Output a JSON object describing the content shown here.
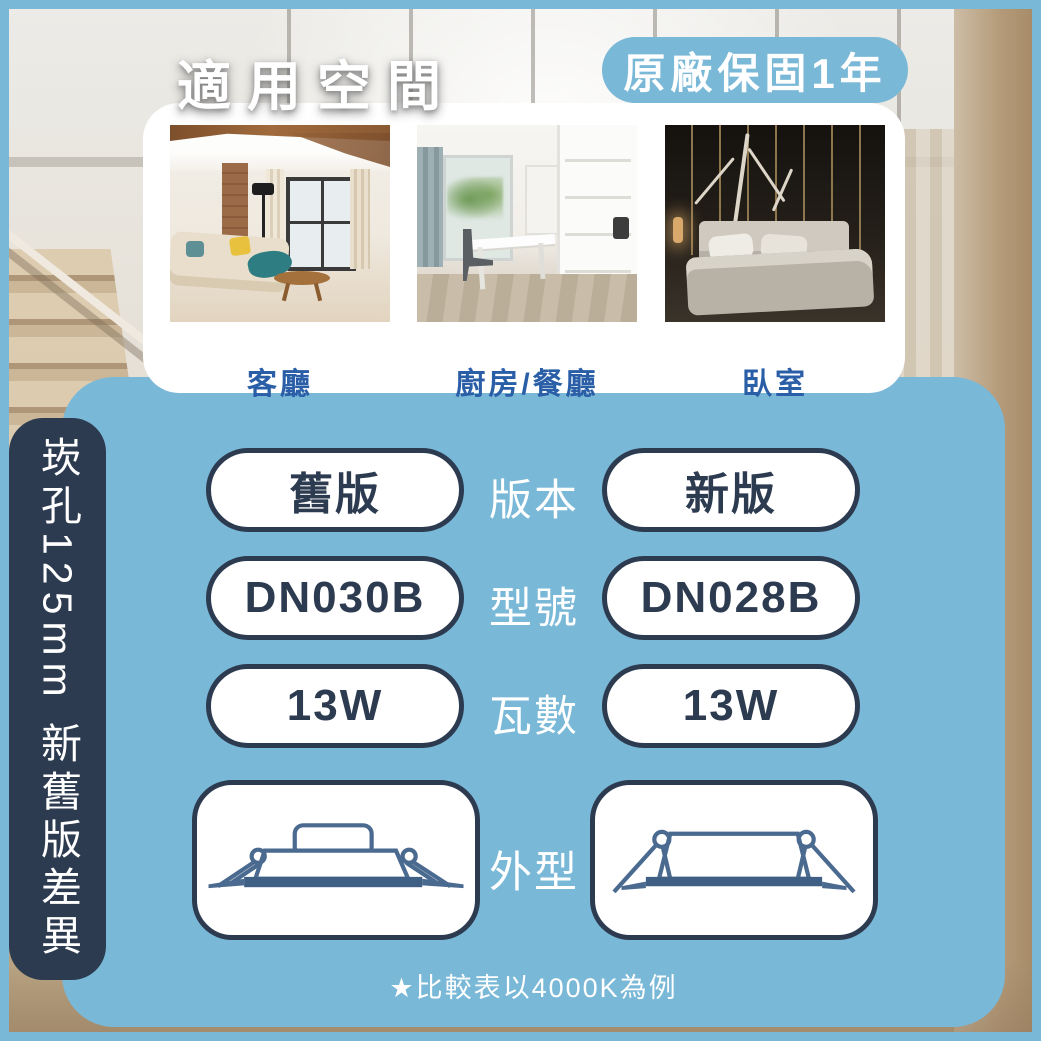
{
  "header": {
    "title": "適用空間",
    "warranty_badge": "原廠保固1年"
  },
  "spaces": [
    {
      "label": "客廳"
    },
    {
      "label": "廚房/餐廳"
    },
    {
      "label": "臥室"
    }
  ],
  "sidebar": {
    "text": "崁孔125mm 新舊版差異"
  },
  "comparison": {
    "old_column": "舊版",
    "new_column": "新版",
    "rows": [
      {
        "label": "版本",
        "old": "舊版",
        "new": "新版"
      },
      {
        "label": "型號",
        "old": "DN030B",
        "new": "DN028B"
      },
      {
        "label": "瓦數",
        "old": "13W",
        "new": "13W"
      }
    ],
    "shape_label": "外型",
    "footnote": "★比較表以4000K為例"
  },
  "colors": {
    "panel_blue": "#7ab8d7",
    "navy": "#2d3b50",
    "label_blue": "#2a5fa8",
    "drawing_blue": "#4a6a90",
    "white": "#ffffff"
  }
}
